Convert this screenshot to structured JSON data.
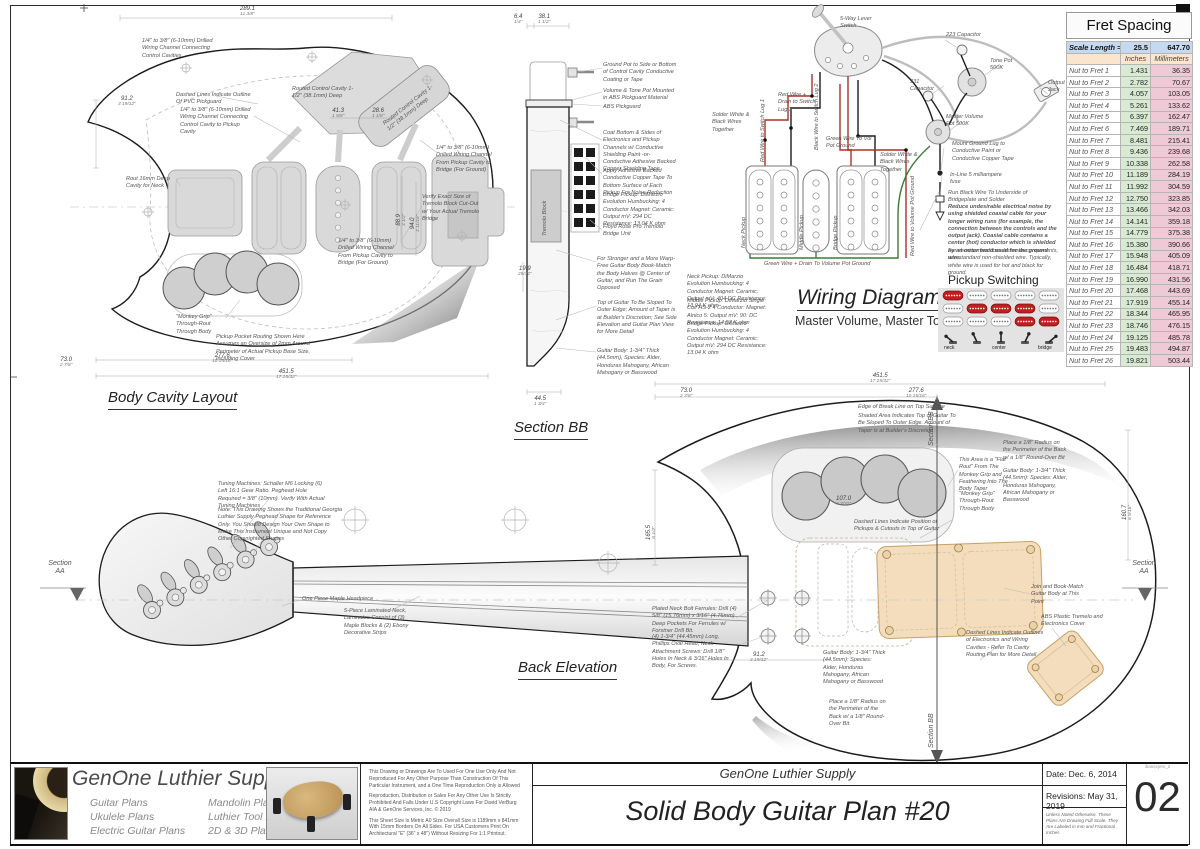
{
  "sheet": {
    "number": "02",
    "file_ref": "ibanezjem_2"
  },
  "fret_table": {
    "title": "Fret Spacing",
    "scale_label": "Scale Length =",
    "scale_inches": "25.5",
    "scale_mm": "647.70",
    "col_inches": "Inches",
    "col_mm": "Millimeters",
    "rows": [
      {
        "label": "Nut to Fret 1",
        "inches": "1.431",
        "mm": "36.35"
      },
      {
        "label": "Nut to Fret 2",
        "inches": "2.782",
        "mm": "70.67"
      },
      {
        "label": "Nut to Fret 3",
        "inches": "4.057",
        "mm": "103.05"
      },
      {
        "label": "Nut to Fret 4",
        "inches": "5.261",
        "mm": "133.62"
      },
      {
        "label": "Nut to Fret 5",
        "inches": "6.397",
        "mm": "162.47"
      },
      {
        "label": "Nut to Fret 6",
        "inches": "7.469",
        "mm": "189.71"
      },
      {
        "label": "Nut to Fret 7",
        "inches": "8.481",
        "mm": "215.41"
      },
      {
        "label": "Nut to Fret 8",
        "inches": "9.436",
        "mm": "239.68"
      },
      {
        "label": "Nut to Fret 9",
        "inches": "10.338",
        "mm": "262.58"
      },
      {
        "label": "Nut to Fret 10",
        "inches": "11.189",
        "mm": "284.19"
      },
      {
        "label": "Nut to Fret 11",
        "inches": "11.992",
        "mm": "304.59"
      },
      {
        "label": "Nut to Fret 12",
        "inches": "12.750",
        "mm": "323.85"
      },
      {
        "label": "Nut to Fret 13",
        "inches": "13.466",
        "mm": "342.03"
      },
      {
        "label": "Nut to Fret 14",
        "inches": "14.141",
        "mm": "359.18"
      },
      {
        "label": "Nut to Fret 15",
        "inches": "14.779",
        "mm": "375.38"
      },
      {
        "label": "Nut to Fret 16",
        "inches": "15.380",
        "mm": "390.66"
      },
      {
        "label": "Nut to Fret 17",
        "inches": "15.948",
        "mm": "405.09"
      },
      {
        "label": "Nut to Fret 18",
        "inches": "16.484",
        "mm": "418.71"
      },
      {
        "label": "Nut to Fret 19",
        "inches": "16.990",
        "mm": "431.56"
      },
      {
        "label": "Nut to Fret 20",
        "inches": "17.468",
        "mm": "443.69"
      },
      {
        "label": "Nut to Fret 21",
        "inches": "17.919",
        "mm": "455.14"
      },
      {
        "label": "Nut to Fret 22",
        "inches": "18.344",
        "mm": "465.95"
      },
      {
        "label": "Nut to Fret 23",
        "inches": "18.746",
        "mm": "476.15"
      },
      {
        "label": "Nut to Fret 24",
        "inches": "19.125",
        "mm": "485.78"
      },
      {
        "label": "Nut to Fret 25",
        "inches": "19.483",
        "mm": "494.87"
      },
      {
        "label": "Nut to Fret 26",
        "inches": "19.821",
        "mm": "503.44"
      }
    ]
  },
  "body_cavity": {
    "title": "Body Cavity Layout",
    "notes": {
      "pickguard": "Dashed Lines Indicate Outline Of PVC Pickguard",
      "channel_control": "1/4\" to 3/8\" (6-10mm) Drilled Wiring Channel Connecting Control Cavities",
      "channel_pickup": "1/4\" to 3/8\" (6-10mm) Drilled Wiring Channel Connecting Control Cavity to Pickup Cavity",
      "control_cavity": "Routed Control Cavity 1-1/2\" (38.1mm) Deep",
      "neck_cavity": "Rout 16mm Deep Cavity for Neck",
      "channel_bridge": "1/4\" to 3/8\" (6-10mm) Drilled Wiring Channel From Pickup Cavity to Bridge (For Ground)",
      "tremolo_verify": "Verify Exact Size of Tremolo Block Cut-Out w/ Your Actual Tremolo Bridge",
      "monkey_grip": "\"Monkey Grip\" Through-Rout Through Body",
      "pickup_pocket": "Pickup Pocket Routing Shown Here Assumes an Oversize of 2mm Around Perimeter of Actual Pickup Base Size, Including Cover"
    },
    "dims": {
      "top": {
        "mm": "289.1",
        "in": "11 3/8\""
      },
      "left": {
        "mm": "91.2",
        "in": "3 19/32\""
      },
      "b0": {
        "mm": "73.0",
        "in": "2 7/8\""
      },
      "w1": {
        "mm": "41.3",
        "in": "1 5/8\""
      },
      "w2": {
        "mm": "28.6",
        "in": "1 1/8\""
      },
      "h1": {
        "mm": "88.9",
        "in": "3 1/2\""
      },
      "h2": {
        "mm": "94.0",
        "in": "3 11/16\""
      },
      "b1": {
        "mm": "277.6",
        "in": "10 15/16\""
      },
      "b2": {
        "mm": "451.5",
        "in": "17 25/32\""
      }
    }
  },
  "section_bb": {
    "title": "Section BB",
    "notes": {
      "ground_pot": "Ground Pot to Side or Bottom of Control Cavity Conductive Coating or Tape",
      "pot_mount": "Volume & Tone Pot Mounted in ABS Pickguard Material",
      "pickguard": "ABS Pickguard",
      "shielding": "Coat Bottom & Sides of Electronics and Pickup Channels w/ Conductive Shielding Paint -or- Conductive Adhesive Backed Copper Shielding Tape",
      "copper_tape": "Apply Adhesive Backed Conductive Copper Tape To Bottom Surface of Each Pickup For Noise Reduction",
      "bridge_spec": "Bridge Pickup: DiMarzio Evolution Humbucking: 4 Conductor Magnet: Ceramic: Output mV: 294 DC Resistance: 13.04 K ohm",
      "floyd_rose": "Floyd Rose Pro Tremolo Bridge Unit",
      "book_match": "For Stronger and a More Warp-Free Guitar Body Book-Match the Body Halves @ Center of Guitar, and Run The Grain Opposed",
      "taper": "Top of Guitar To Be Sloped To Outer Edge; Amount of Taper is at Builder's Discretion; See Side Elevation and Guitar Plan View for More Detail",
      "body_spec": "Guitar Body: 1-3/4\" Thick (44.5mm), Species: Alder, Honduras Mahogany, African Mahogany or Basswood",
      "tremolo_block": "Tremolo Block"
    },
    "dims": {
      "t1": {
        "mm": "6.4",
        "in": "1/4\""
      },
      "t2": {
        "mm": "38.1",
        "in": "1 1/2\""
      },
      "left": {
        "mm": "19.9",
        "in": "25/32\""
      },
      "bottom": {
        "mm": "44.5",
        "in": "1 3/4\""
      }
    }
  },
  "wiring": {
    "title": "Wiring Diagram",
    "subtitle": "Master Volume, Master Tone",
    "labels": {
      "switch": "5-Way Lever Switch",
      "cap223": "223 Capacitor",
      "tone_pot": "Tone Pot 500K",
      "cap331": "331 Capacitor",
      "output_jack": "Output Jack",
      "master_vol": "Master Volume Pot 500K",
      "red_drain": "Red Wire + Drain to Switch Lug 3",
      "red_lug1": "Red Wire to Switch Lug 1",
      "black_lug2": "Black Wire to Switch Lug 2",
      "solder_white": "Solder White & Black Wires Together",
      "green_vol": "Green Wire To Vol Pot Ground",
      "ground_lug": "Mount Ground Lug to Conductive Paint or Conductive Copper Tape",
      "fuse": "In-Line 5 milliampere fuse",
      "black_bridge": "Run Black Wire To Underside of Bridgeplate and Solder",
      "green_drain": "Green Wire + Drain To Volume Pot Ground",
      "neck_pickup": "Neck Pickup",
      "middle_pickup": "Middle Pickup",
      "bridge_pickup": "Bridge Pickup",
      "red_vol": "Red Wire to Volume Pot Ground"
    },
    "notes": {
      "noise": "Reduce undesirable electrical noise by using shielded coaxial cable for your longer wiring runs (for example, the connection between the controls and the output jack). Coaxial cable contains a center (hot) conductor which is shielded by an outer braid used for the ground wire.",
      "short_runs": "For short connections between components, use standard non-shielded wire. Typically, white wire is used for hot and black for ground."
    },
    "specs": {
      "neck": "Neck Pickup: DiMarzio Evolution Humbucking: 4 Conductor Magnet: Ceramic: Output mV: 404 DC Resistance: 13.94 K ohm",
      "middle": "Middle Pickup: DiMarzio Single Coil HS-2 4 Conductor: Magnet: Alnico 5: Output mV: 90: DC Resistance: 14.97 K ohm",
      "bridge": "Bridge Pickup: DiMarzio Evolution Humbucking: 4 Conductor Magnet: Ceramic: Output mV: 294 DC Resistance: 13.04 K ohm"
    },
    "pickup_switching": {
      "title": "Pickup Switching",
      "labels": [
        "neck",
        "center",
        "bridge"
      ],
      "grid": {
        "neck": [
          1,
          0,
          0,
          0,
          0
        ],
        "center": [
          0,
          1,
          1,
          1,
          0
        ],
        "bridge": [
          0,
          0,
          0,
          1,
          1
        ]
      },
      "active_color": "#c01f1f"
    }
  },
  "back_elevation": {
    "title": "Back Elevation",
    "notes": {
      "tuners": "Tuning Machines: Schaller M6 Locking (6) Left 16:1 Gear Ratio. Peghead Hole Required = 3/8\" (10mm). Verify With Actual Tuning Machines",
      "peghead_note": "Note: This Drawing Shows the Traditional Georgia Luthier Supply Peghead Shape for Reference Only. You Should Design Your Own Shape to Make This Instrument Unique and Not Copy Other Copyrighted Shapes",
      "headpiece": "One Piece Maple Headpiece",
      "laminated_neck": "5-Piece Laminated Neck, Laminates Consist of (3) Maple Blocks & (2) Ebony Decorative Strips",
      "ferrules": "Plated Neck Bolt Ferrules: Drill (4) 5/8\" (15.76mm) x 3/16\" (4.76mm) Deep Pockets For Ferrules w/ Forstner Drill Bit.",
      "screws": "(4) 1-3/4\" (44.45mm) Long, Phillips Oval Head, Neck Attachment Screws: Drill 1/8\" Holes In Neck & 3/16\" Holes In Body, For Screws.",
      "break_line": "Edge of Break Line on Top Surface",
      "shaded": "Shaded Area Indicates Top of Guitar To Be Sloped To Outer Edge. Amount of Taper is at Builder's Discretion",
      "flat_rout": "This Area is a \"Flat Rout\" From The Monkey Grip and Feathering Into The Body Taper",
      "monkey_grip": "\"Monkey Grip\" Through-Rout Through Body",
      "dashed_pickups": "Dashed Lines Indicate Position of Pickups & Cutouts in Top of Guitar",
      "radius": "Place a 1/8\" Radius on the Perimeter of the Back w/ a 1/8\" Round-Over Bit",
      "body_spec": "Guitar Body: 1-3/4\" Thick (44.5mm): Species: Alder, Honduras Mahogany, African Mahogany or Basswood",
      "book_match": "Join and Book-Match Guitar Body at This Point",
      "abs_cover": "ABS Plastic Tremelo and Electronics Cover",
      "cavity_outlines": "Dashed Lines Indicate Outlines of Electronics and Wiring Cavities - Refer To Cavity Routing Plan for More Detail"
    },
    "dims": {
      "d73": {
        "mm": "73.0",
        "in": "2 7/8\""
      },
      "d277": {
        "mm": "277.6",
        "in": "10 15/16\""
      },
      "d451": {
        "mm": "451.5",
        "in": "17 25/32\""
      },
      "d165": {
        "mm": "165.5",
        "in": "6 1/2\""
      },
      "d107": {
        "mm": "107.0",
        "in": "4 7/32\""
      },
      "d160": {
        "mm": "160.7",
        "in": "6 5/16\""
      },
      "d91": {
        "mm": "91.2",
        "in": "3 19/32\""
      }
    },
    "markers": {
      "section": "Section",
      "aa": "AA",
      "bb": "Section BB"
    }
  },
  "title_block": {
    "brand": "GenOne Luthier Supplies",
    "categories_col1": [
      "Guitar Plans",
      "Ukulele Plans",
      "Electric Guitar Plans"
    ],
    "categories_col2": [
      "Mandolin Plans",
      "Luthier Tool Plans",
      "2D & 3D Plans"
    ],
    "legal1": "This Drawing or Drawings Are To Used For One Use Only And Not Reproduced For Any Other Purpose Than Construction Of This Particular Instrument, and a One Time Reproduction Only is Allowed",
    "legal2": "Reproduction, Distribution or Sales For Any Other Use Is Strictly Prohibited And Falls Under U.S Copyright Laws For David VerBurg AIA & GenOne Services, Inc. © 2019",
    "legal3": "This Sheet Size Is Metric A0 Size Overall Size is 1189mm x 841mm With 15mm Borders On All Sides. For USA Customers Print On Architectural \"E\" (36\" x 48\") Without Resizing For 1:1 Printout.",
    "company": "GenOne Luthier Supply",
    "plan_title": "Solid Body Guitar Plan #20",
    "date": "Date: Dec. 6, 2014",
    "revisions": "Revisions: May 31, 2019",
    "scale_note": "Unless Noted Otherwise, These Plans Are Drawing Full Scale. They Are Labeled in mm and Fractional Inches"
  }
}
